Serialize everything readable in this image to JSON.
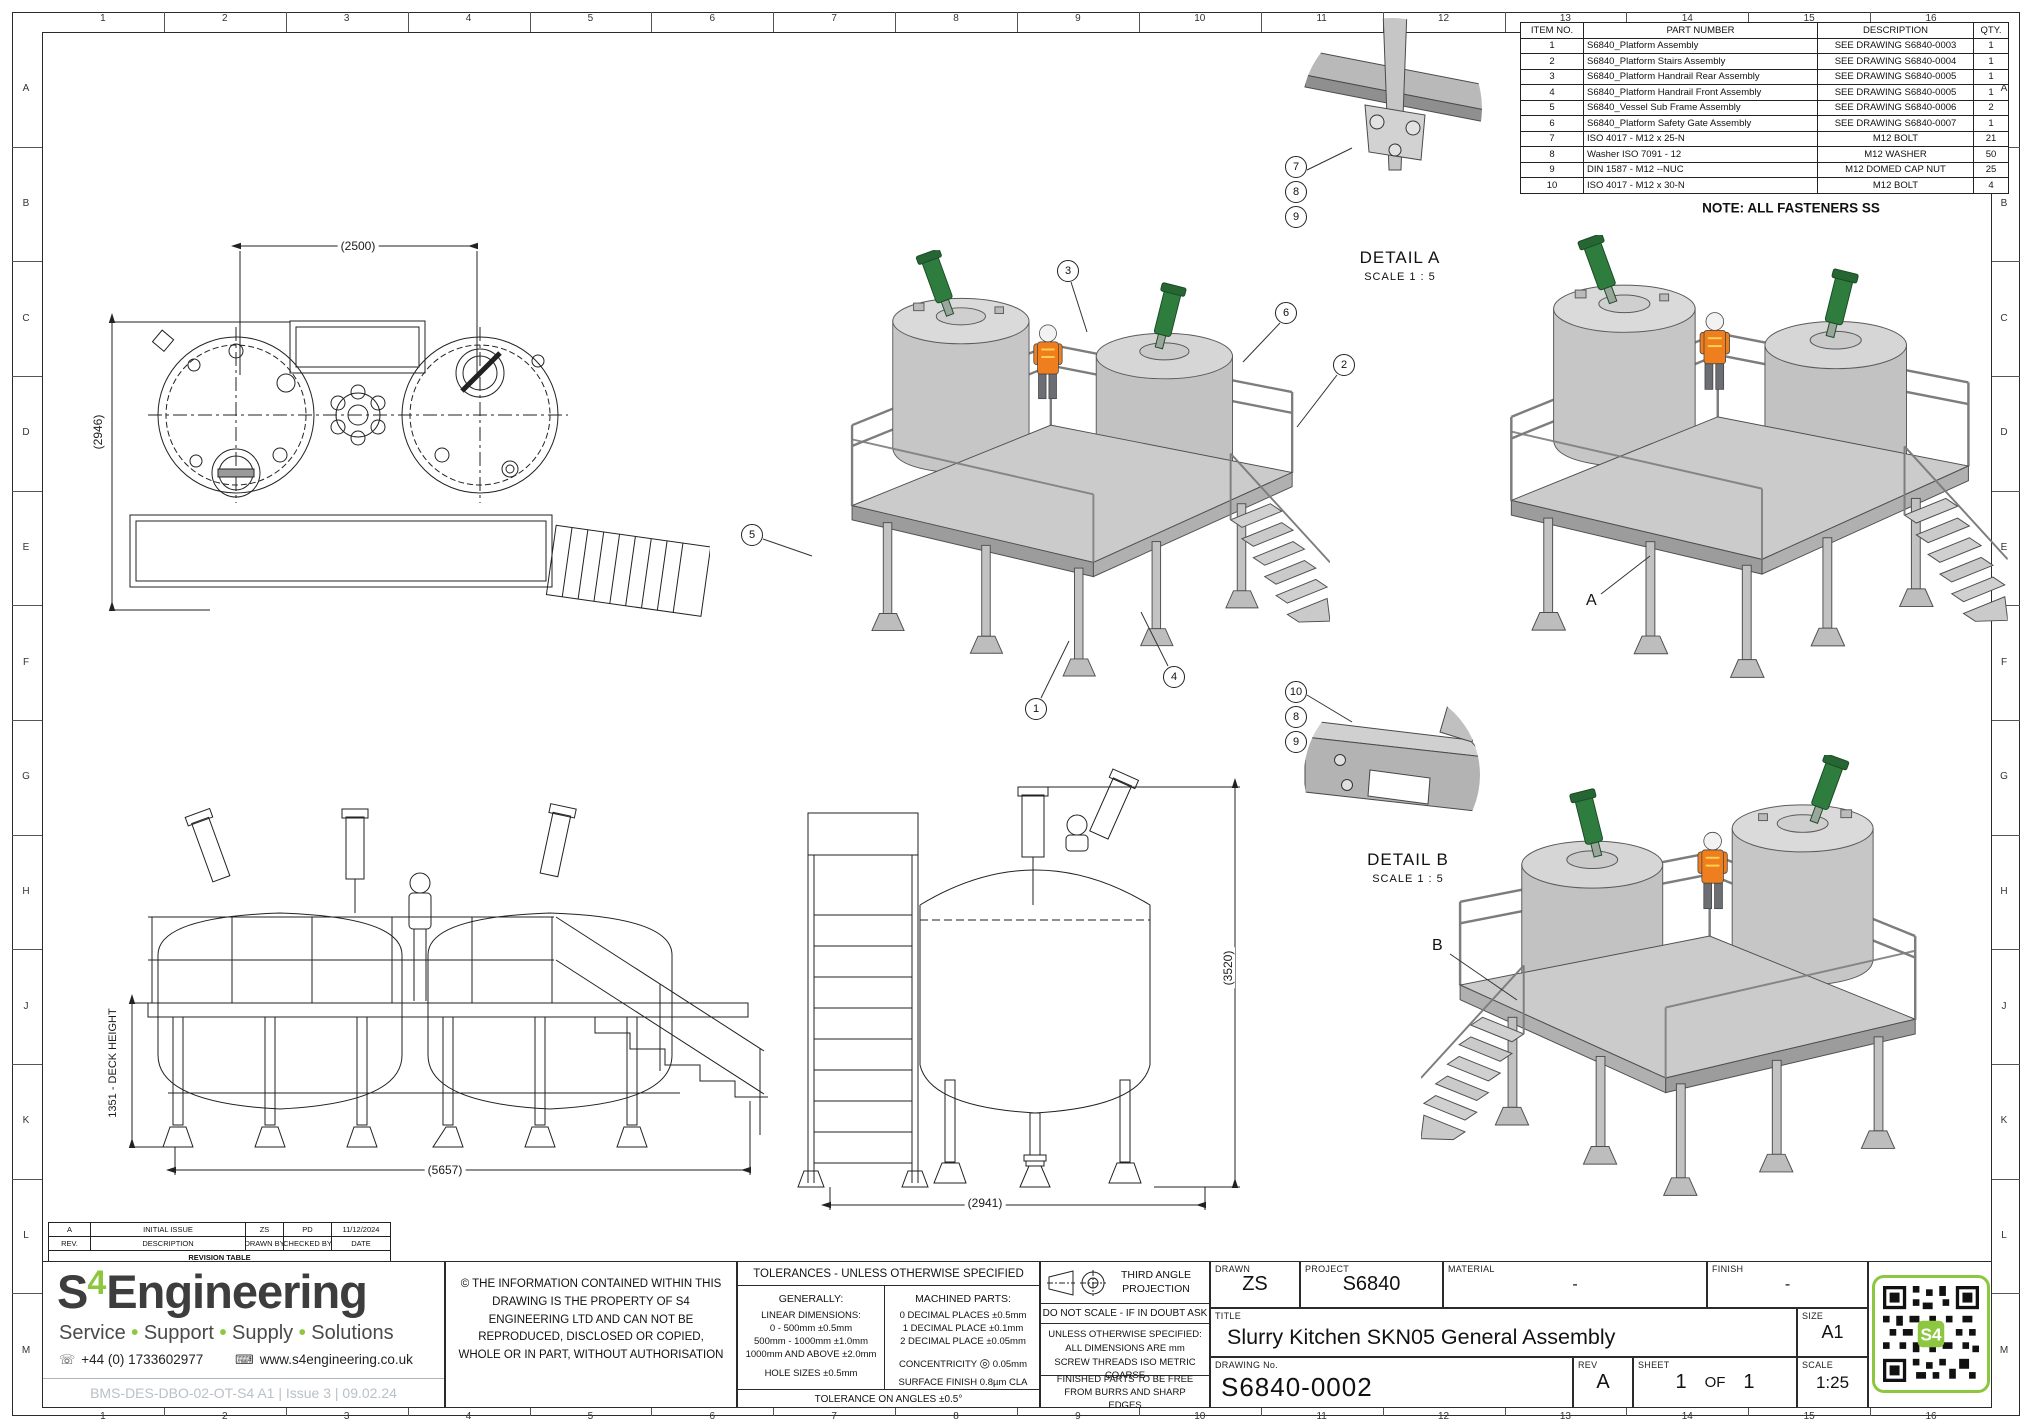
{
  "sheet": {
    "grid_cols": [
      "1",
      "2",
      "3",
      "4",
      "5",
      "6",
      "7",
      "8",
      "9",
      "10",
      "11",
      "12",
      "13",
      "14",
      "15",
      "16"
    ],
    "grid_rows": [
      "A",
      "B",
      "C",
      "D",
      "E",
      "F",
      "G",
      "H",
      "J",
      "K",
      "L",
      "M"
    ],
    "note": "NOTE: ALL FASTENERS SS"
  },
  "bom": {
    "headers": [
      "ITEM NO.",
      "PART NUMBER",
      "DESCRIPTION",
      "QTY."
    ],
    "rows": [
      [
        "1",
        "S6840_Platform Assembly",
        "SEE DRAWING S6840-0003",
        "1"
      ],
      [
        "2",
        "S6840_Platform Stairs Assembly",
        "SEE DRAWING S6840-0004",
        "1"
      ],
      [
        "3",
        "S6840_Platform Handrail Rear Assembly",
        "SEE DRAWING S6840-0005",
        "1"
      ],
      [
        "4",
        "S6840_Platform Handrail Front Assembly",
        "SEE DRAWING S6840-0005",
        "1"
      ],
      [
        "5",
        "S6840_Vessel Sub Frame Assembly",
        "SEE DRAWING S6840-0006",
        "2"
      ],
      [
        "6",
        "S6840_Platform Safety Gate Assembly",
        "SEE DRAWING S6840-0007",
        "1"
      ],
      [
        "7",
        "ISO 4017 - M12 x 25-N",
        "M12 BOLT",
        "21"
      ],
      [
        "8",
        "Washer ISO 7091 - 12",
        "M12 WASHER",
        "50"
      ],
      [
        "9",
        "DIN 1587 - M12 --NUC",
        "M12 DOMED CAP NUT",
        "25"
      ],
      [
        "10",
        "ISO 4017 - M12 x 30-N",
        "M12 BOLT",
        "4"
      ]
    ]
  },
  "details": {
    "a": {
      "title": "DETAIL A",
      "scale": "SCALE 1 : 5",
      "balloons": [
        "7",
        "8",
        "9"
      ]
    },
    "b": {
      "title": "DETAIL B",
      "scale": "SCALE 1 : 5",
      "balloons": [
        "10",
        "8",
        "9"
      ]
    }
  },
  "views": {
    "top": {
      "dim_width": "(2500)",
      "dim_height": "(2946)"
    },
    "front": {
      "dim_width": "(5657)",
      "dim_height": "1351 - DECK HEIGHT"
    },
    "elevation": {
      "dim_width": "(2941)",
      "dim_height": "(3520)"
    },
    "iso_main": {
      "balloons": [
        "3",
        "6",
        "2",
        "5",
        "1",
        "4"
      ]
    },
    "iso_right": {
      "section_label": "A"
    },
    "iso_lower": {
      "section_label": "B"
    }
  },
  "revision": {
    "caption": "REVISION TABLE",
    "headers": [
      "REV.",
      "DESCRIPTION",
      "DRAWN BY",
      "CHECKED BY",
      "DATE"
    ],
    "rows": [
      [
        "A",
        "INITIAL ISSUE",
        "ZS",
        "PD",
        "11/12/2024"
      ]
    ]
  },
  "brand": {
    "s": "S",
    "four": "4",
    "rest": "Engineering",
    "tagline": [
      "Service",
      "Support",
      "Supply",
      "Solutions"
    ],
    "phone": "+44 (0) 1733602977",
    "website": "www.s4engineering.co.uk",
    "doc_ref": "BMS-DES-DBO-02-OT-S4 A1  |  Issue 3  |  09.02.24",
    "qr_label": "S4",
    "accent_color": "#8dc63f",
    "icons": {
      "phone": "☏",
      "web": "⌨"
    }
  },
  "copyright": "© THE INFORMATION CONTAINED WITHIN THIS DRAWING IS THE PROPERTY OF S4 ENGINEERING LTD AND CAN NOT BE REPRODUCED, DISCLOSED OR COPIED, WHOLE OR IN PART, WITHOUT AUTHORISATION",
  "tolerances": {
    "title": "TOLERANCES - UNLESS OTHERWISE SPECIFIED",
    "generally": "GENERALLY:",
    "linear_title": "LINEAR DIMENSIONS:",
    "linear": [
      "0 - 500mm ±0.5mm",
      "500mm - 1000mm ±1.0mm",
      "1000mm AND ABOVE ±2.0mm"
    ],
    "holes": "HOLE SIZES ±0.5mm",
    "machined_title": "MACHINED PARTS:",
    "machined": [
      "0 DECIMAL PLACES ±0.5mm",
      "1 DECIMAL PLACE ±0.1mm",
      "2 DECIMAL PLACE ±0.05mm"
    ],
    "concentricity_label": "CONCENTRICITY",
    "concentricity_symbol": "◎",
    "concentricity_value": "0.05mm",
    "surface": "SURFACE FINISH 0.8µm CLA",
    "angles": "TOLERANCE ON ANGLES ±0.5°"
  },
  "projection": {
    "third_angle": "THIRD ANGLE PROJECTION",
    "do_not_scale": "DO NOT SCALE - IF IN DOUBT ASK",
    "unless": [
      "UNLESS OTHERWISE SPECIFIED:",
      "ALL DIMENSIONS ARE mm",
      "SCREW THREADS ISO METRIC COARSE"
    ],
    "finished": "FINISHED PARTS TO BE FREE FROM BURRS AND SHARP EDGES"
  },
  "title_block": {
    "drawn_label": "DRAWN",
    "drawn_value": "ZS",
    "project_label": "PROJECT",
    "project_value": "S6840",
    "material_label": "MATERIAL",
    "material_value": "-",
    "finish_label": "FINISH",
    "finish_value": "-",
    "title_label": "TITLE",
    "title_value": "Slurry Kitchen SKN05 General Assembly",
    "size_label": "SIZE",
    "size_value": "A1",
    "drawing_no_label": "DRAWING  No.",
    "drawing_no_value": "S6840-0002",
    "rev_label": "REV",
    "rev_value": "A",
    "sheet_label": "SHEET",
    "sheet_num": "1",
    "of_label": "OF",
    "sheet_total": "1",
    "scale_label": "SCALE",
    "scale_value": "1:25"
  }
}
